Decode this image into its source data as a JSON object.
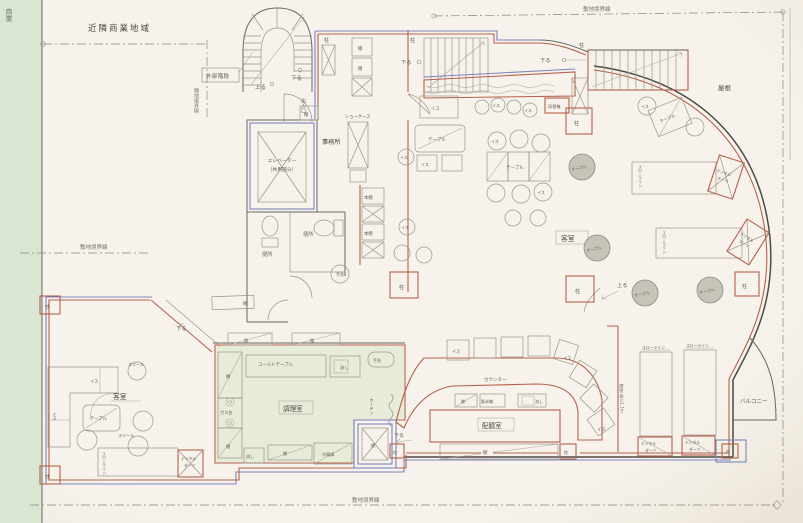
{
  "site": {
    "zoning_area": "近隣商業地域",
    "zoning_area_partial": "商業",
    "site_boundary": "敷地境界線",
    "adjacent_boundary": "隣地境界線",
    "roof": "屋根",
    "balcony": "バルコニー",
    "knee_wall": "腰壁 高さ1.1m"
  },
  "circulation": {
    "exterior_stair": "外部階段",
    "entrance": "出入口",
    "up": "上る",
    "down": "下る",
    "elevator": "エレベーター",
    "elevator_note": "（共用部分）"
  },
  "rooms": {
    "office": "事務所",
    "toilet": "便所",
    "guest_room": "客室",
    "kitchen": "調理室",
    "pantry": "配膳室"
  },
  "equipment": {
    "pillar": "柱",
    "shelf": "棚",
    "bookshelf": "本棚",
    "showcase": "ショーケース",
    "hand_wash": "手洗",
    "sink": "流し",
    "gas_stove": "ガス台",
    "cold_table": "コールドテーブル",
    "refrigerator": "冷蔵庫",
    "ice_maker": "製氷機",
    "counter": "カウンター",
    "curtain": "カーテン",
    "money_changer": "両替機",
    "table": "テーブル",
    "chair": "イス",
    "stool": "スツール"
  },
  "darts": {
    "machine": "デジタルダーツ",
    "machine_l1": "デジタル",
    "machine_l2": "ダーツ",
    "throw_line": "スローライン"
  }
}
